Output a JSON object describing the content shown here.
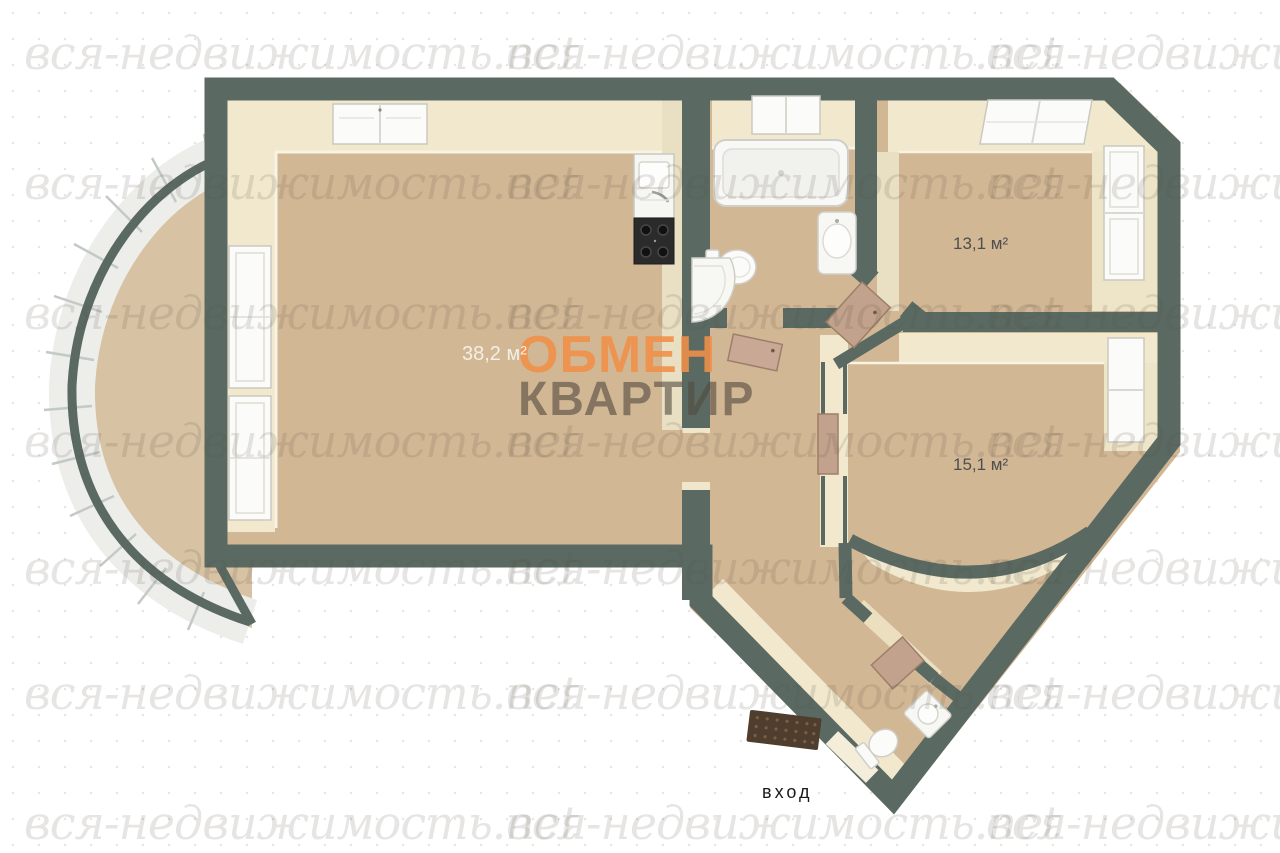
{
  "watermark": {
    "text": "вся-недвижимость.net"
  },
  "overlay": {
    "line1": "ОБМЕН",
    "line2": "КВАРТИР",
    "line1_color": "#f08f48",
    "line2_color": "#524a3e"
  },
  "rooms": {
    "living": {
      "area_label": "38,2 м²"
    },
    "bedroom": {
      "area_label": "13,1 м²"
    },
    "room2": {
      "area_label": "15,1 м²"
    }
  },
  "entrance": {
    "label": "вход"
  },
  "plan_colors": {
    "wall": "#5a6a62",
    "floor": "#d2b795",
    "inner_wall_face": "#f1e8ce",
    "fixture_white": "#f8f8f5",
    "door": "#c2a28c",
    "stove": "#2b2b2b",
    "doormat": "#4f3d2e",
    "balcony_glazing": "#ededea"
  }
}
